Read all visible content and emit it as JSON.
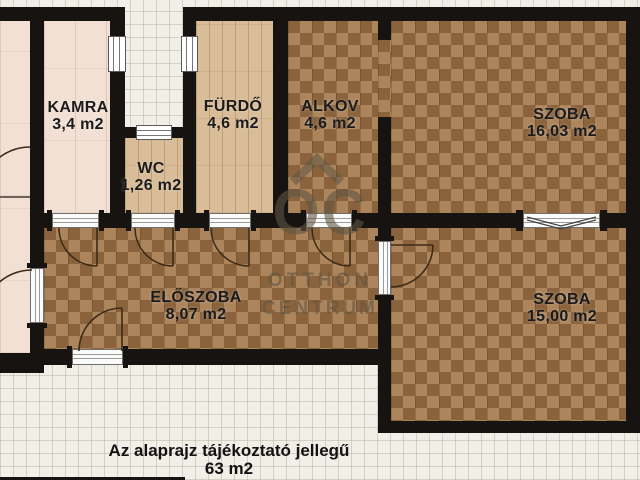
{
  "floorplan": {
    "rooms": [
      {
        "name": "KAMRA",
        "area": "3,4 m2"
      },
      {
        "name": "WC",
        "area": "1,26 m2"
      },
      {
        "name": "FÜRDŐ",
        "area": "4,6 m2"
      },
      {
        "name": "ALKOV",
        "area": "4,6 m2"
      },
      {
        "name": "SZOBA",
        "area": "16,03 m2"
      },
      {
        "name": "ELŐSZOBA",
        "area": "8,07 m2"
      },
      {
        "name": "SZOBA",
        "area": "15,00 m2"
      }
    ],
    "caption": {
      "line1": "Az alaprajz tájékoztató jellegű",
      "line2": "63 m2"
    }
  },
  "watermark": {
    "monogram": "OC",
    "line1": "OTTHON",
    "line2": "CENTRUM"
  },
  "colors": {
    "wall": "#171310",
    "background": "#f2efe8",
    "wood_dark": "#a1754a",
    "wood_light": "#d9bc98",
    "floor_pink": "#f2e0d4",
    "label": "#1b1b1b"
  }
}
